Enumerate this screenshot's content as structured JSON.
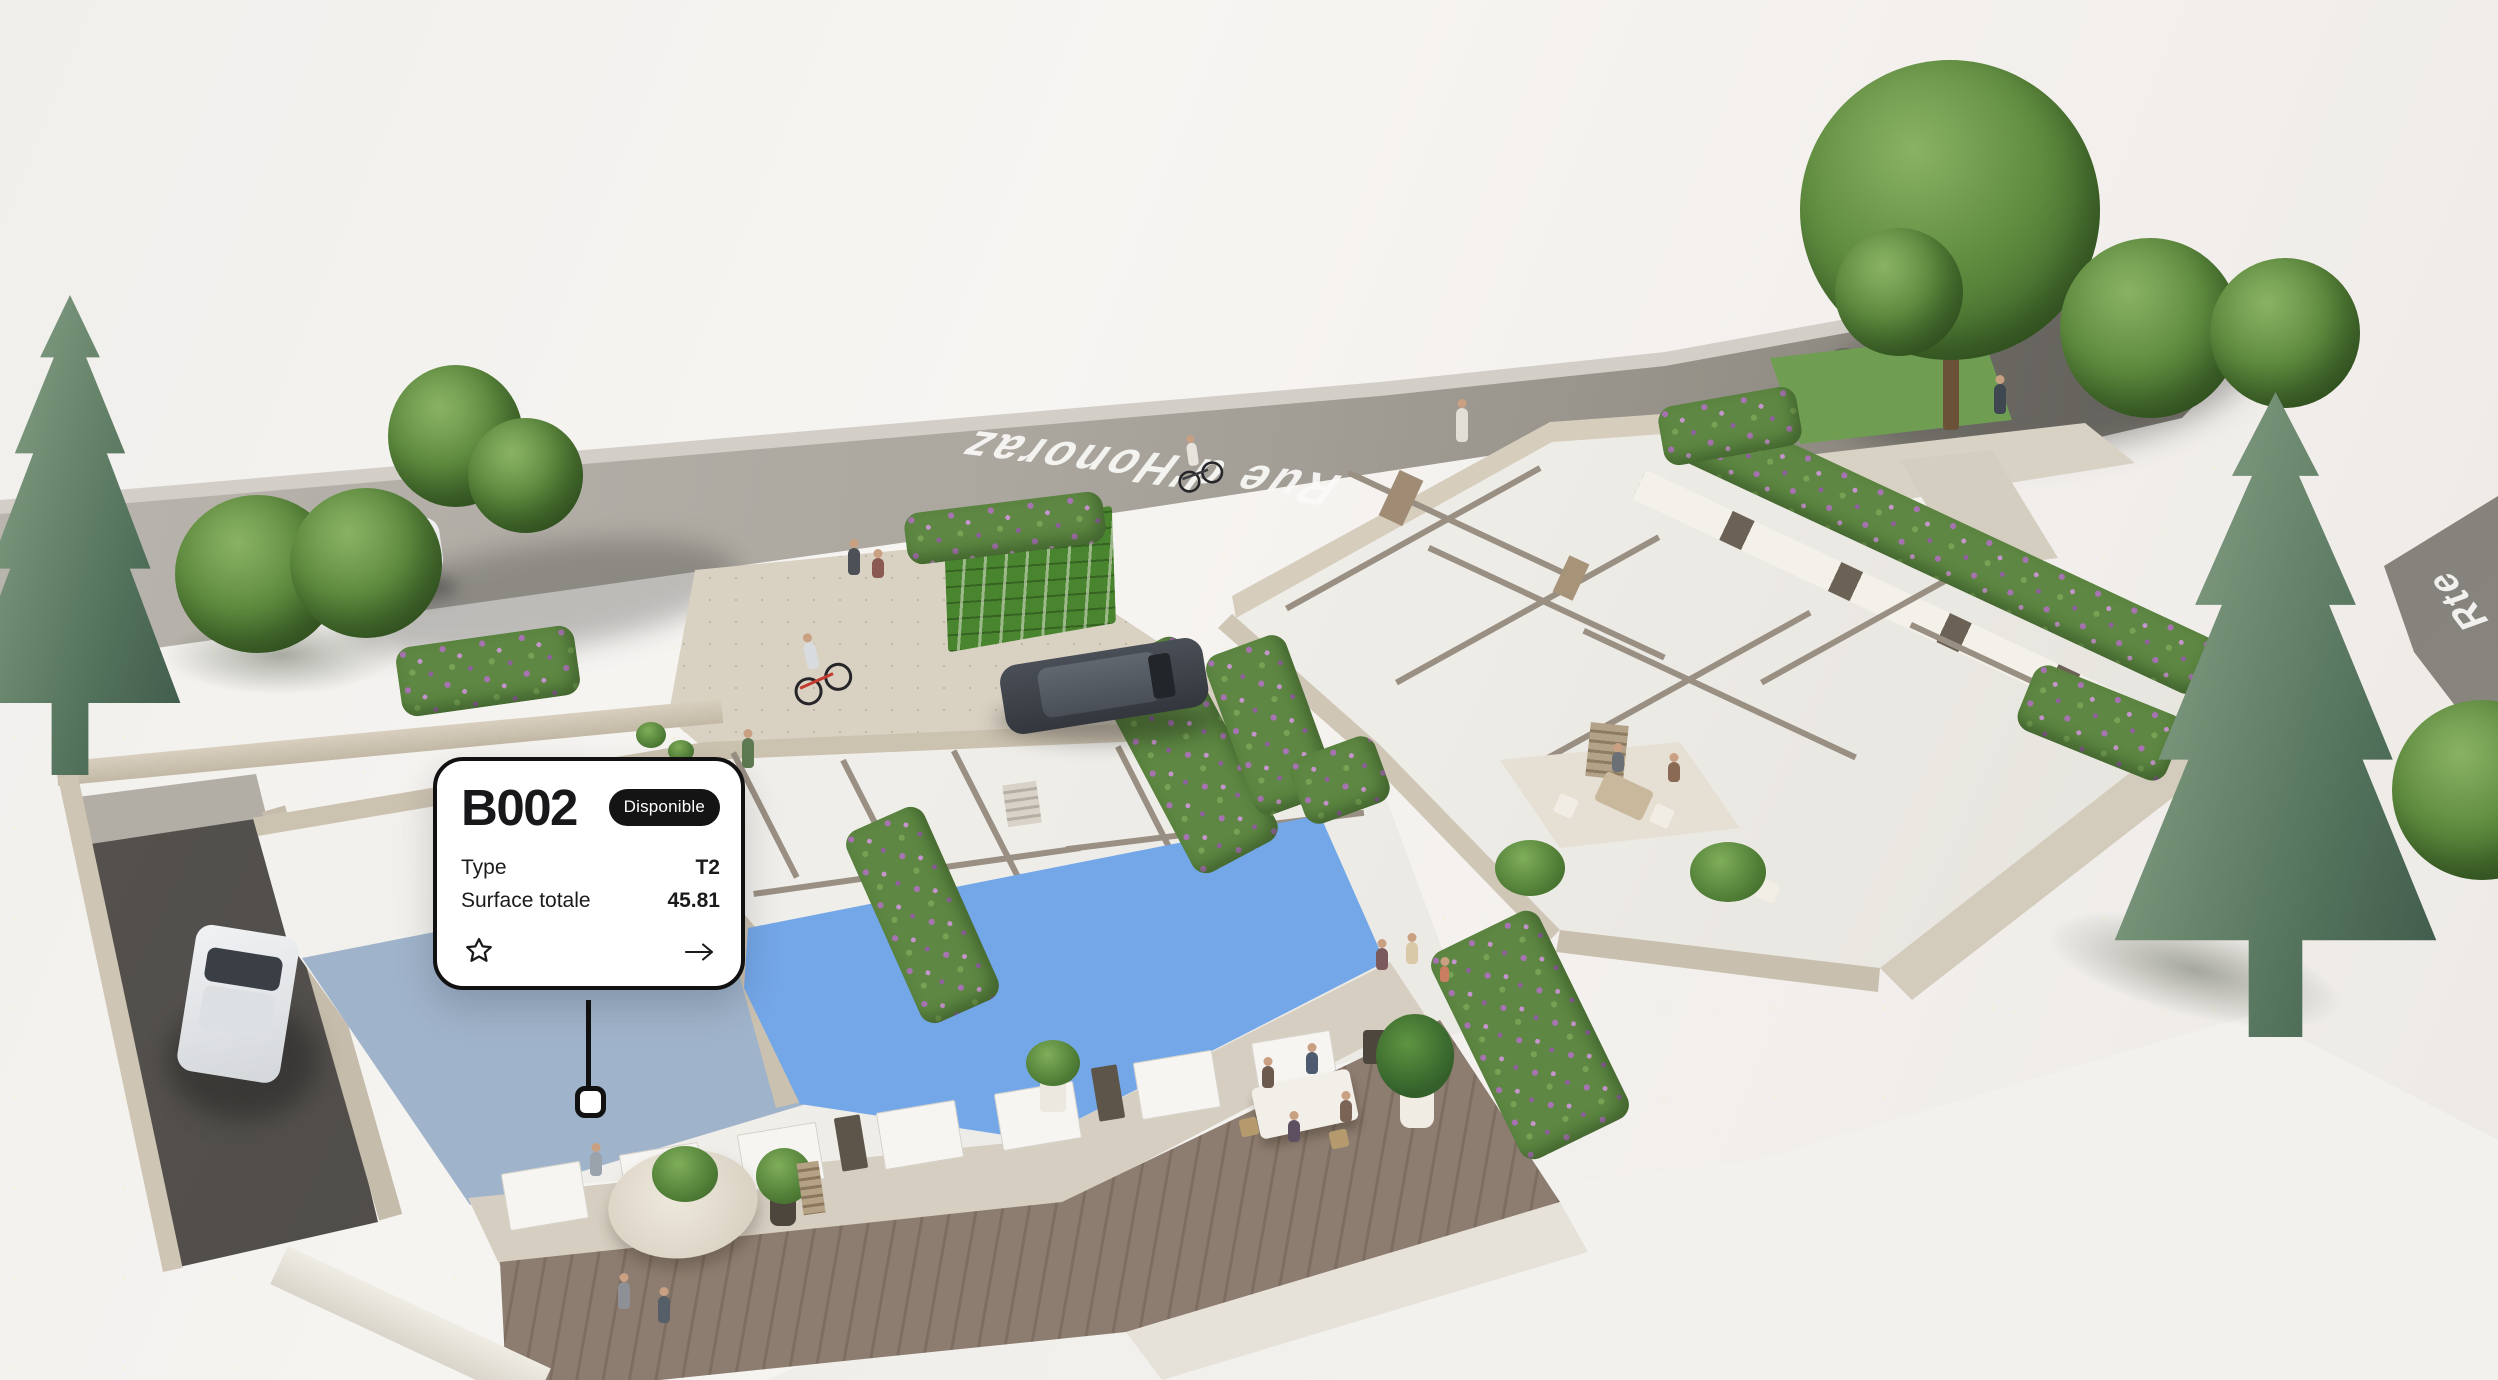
{
  "map": {
    "street_label": "Rue d'Honoraz",
    "street_label_right": "Rte",
    "colors": {
      "hovered_unit": "#9fb3ca",
      "available_unit": "#74a7e8",
      "badge_bg": "#141414",
      "badge_text": "#ffffff"
    }
  },
  "card": {
    "title": "B002",
    "badge": "Disponible",
    "rows": [
      {
        "label": "Type",
        "value": "T2"
      },
      {
        "label": "Surface totale",
        "value": "45.81"
      }
    ]
  }
}
